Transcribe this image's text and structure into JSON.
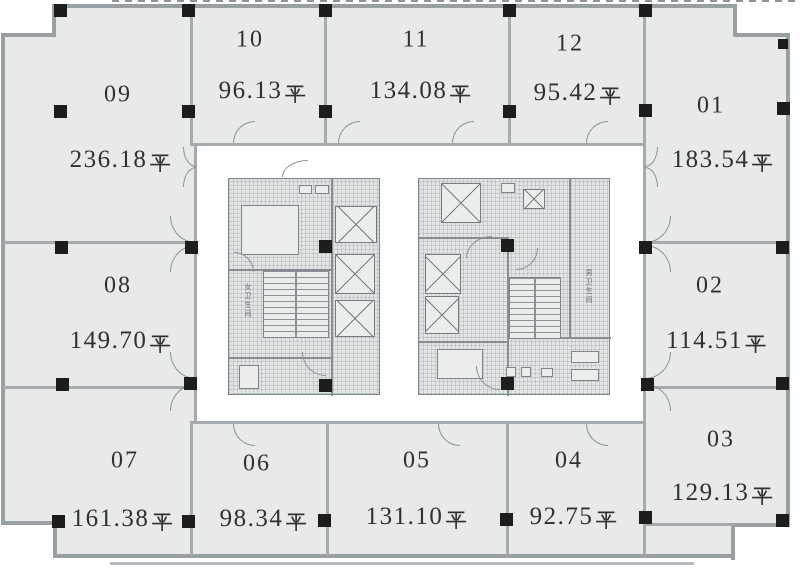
{
  "page": {
    "type": "architectural floor plan",
    "language": "zh"
  },
  "area_unit": "平",
  "units": [
    {
      "id": "09",
      "area": "236.18"
    },
    {
      "id": "10",
      "area": "96.13"
    },
    {
      "id": "11",
      "area": "134.08"
    },
    {
      "id": "12",
      "area": "95.42"
    },
    {
      "id": "01",
      "area": "183.54"
    },
    {
      "id": "08",
      "area": "149.70"
    },
    {
      "id": "02",
      "area": "114.51"
    },
    {
      "id": "07",
      "area": "161.38"
    },
    {
      "id": "06",
      "area": "98.34"
    },
    {
      "id": "05",
      "area": "131.10"
    },
    {
      "id": "04",
      "area": "92.75"
    },
    {
      "id": "03",
      "area": "129.13"
    }
  ],
  "cores": {
    "left": {
      "restroom_label": "女卫生间"
    },
    "right": {
      "restroom_label": "男卫生间"
    }
  },
  "colors": {
    "floor": "#e8eaea",
    "outer_wall": "#98a0a4",
    "inner_wall": "#a4aaae",
    "column": "#1d1d1d",
    "text": "#2e3032",
    "core_fill": "#e2e5e5"
  }
}
